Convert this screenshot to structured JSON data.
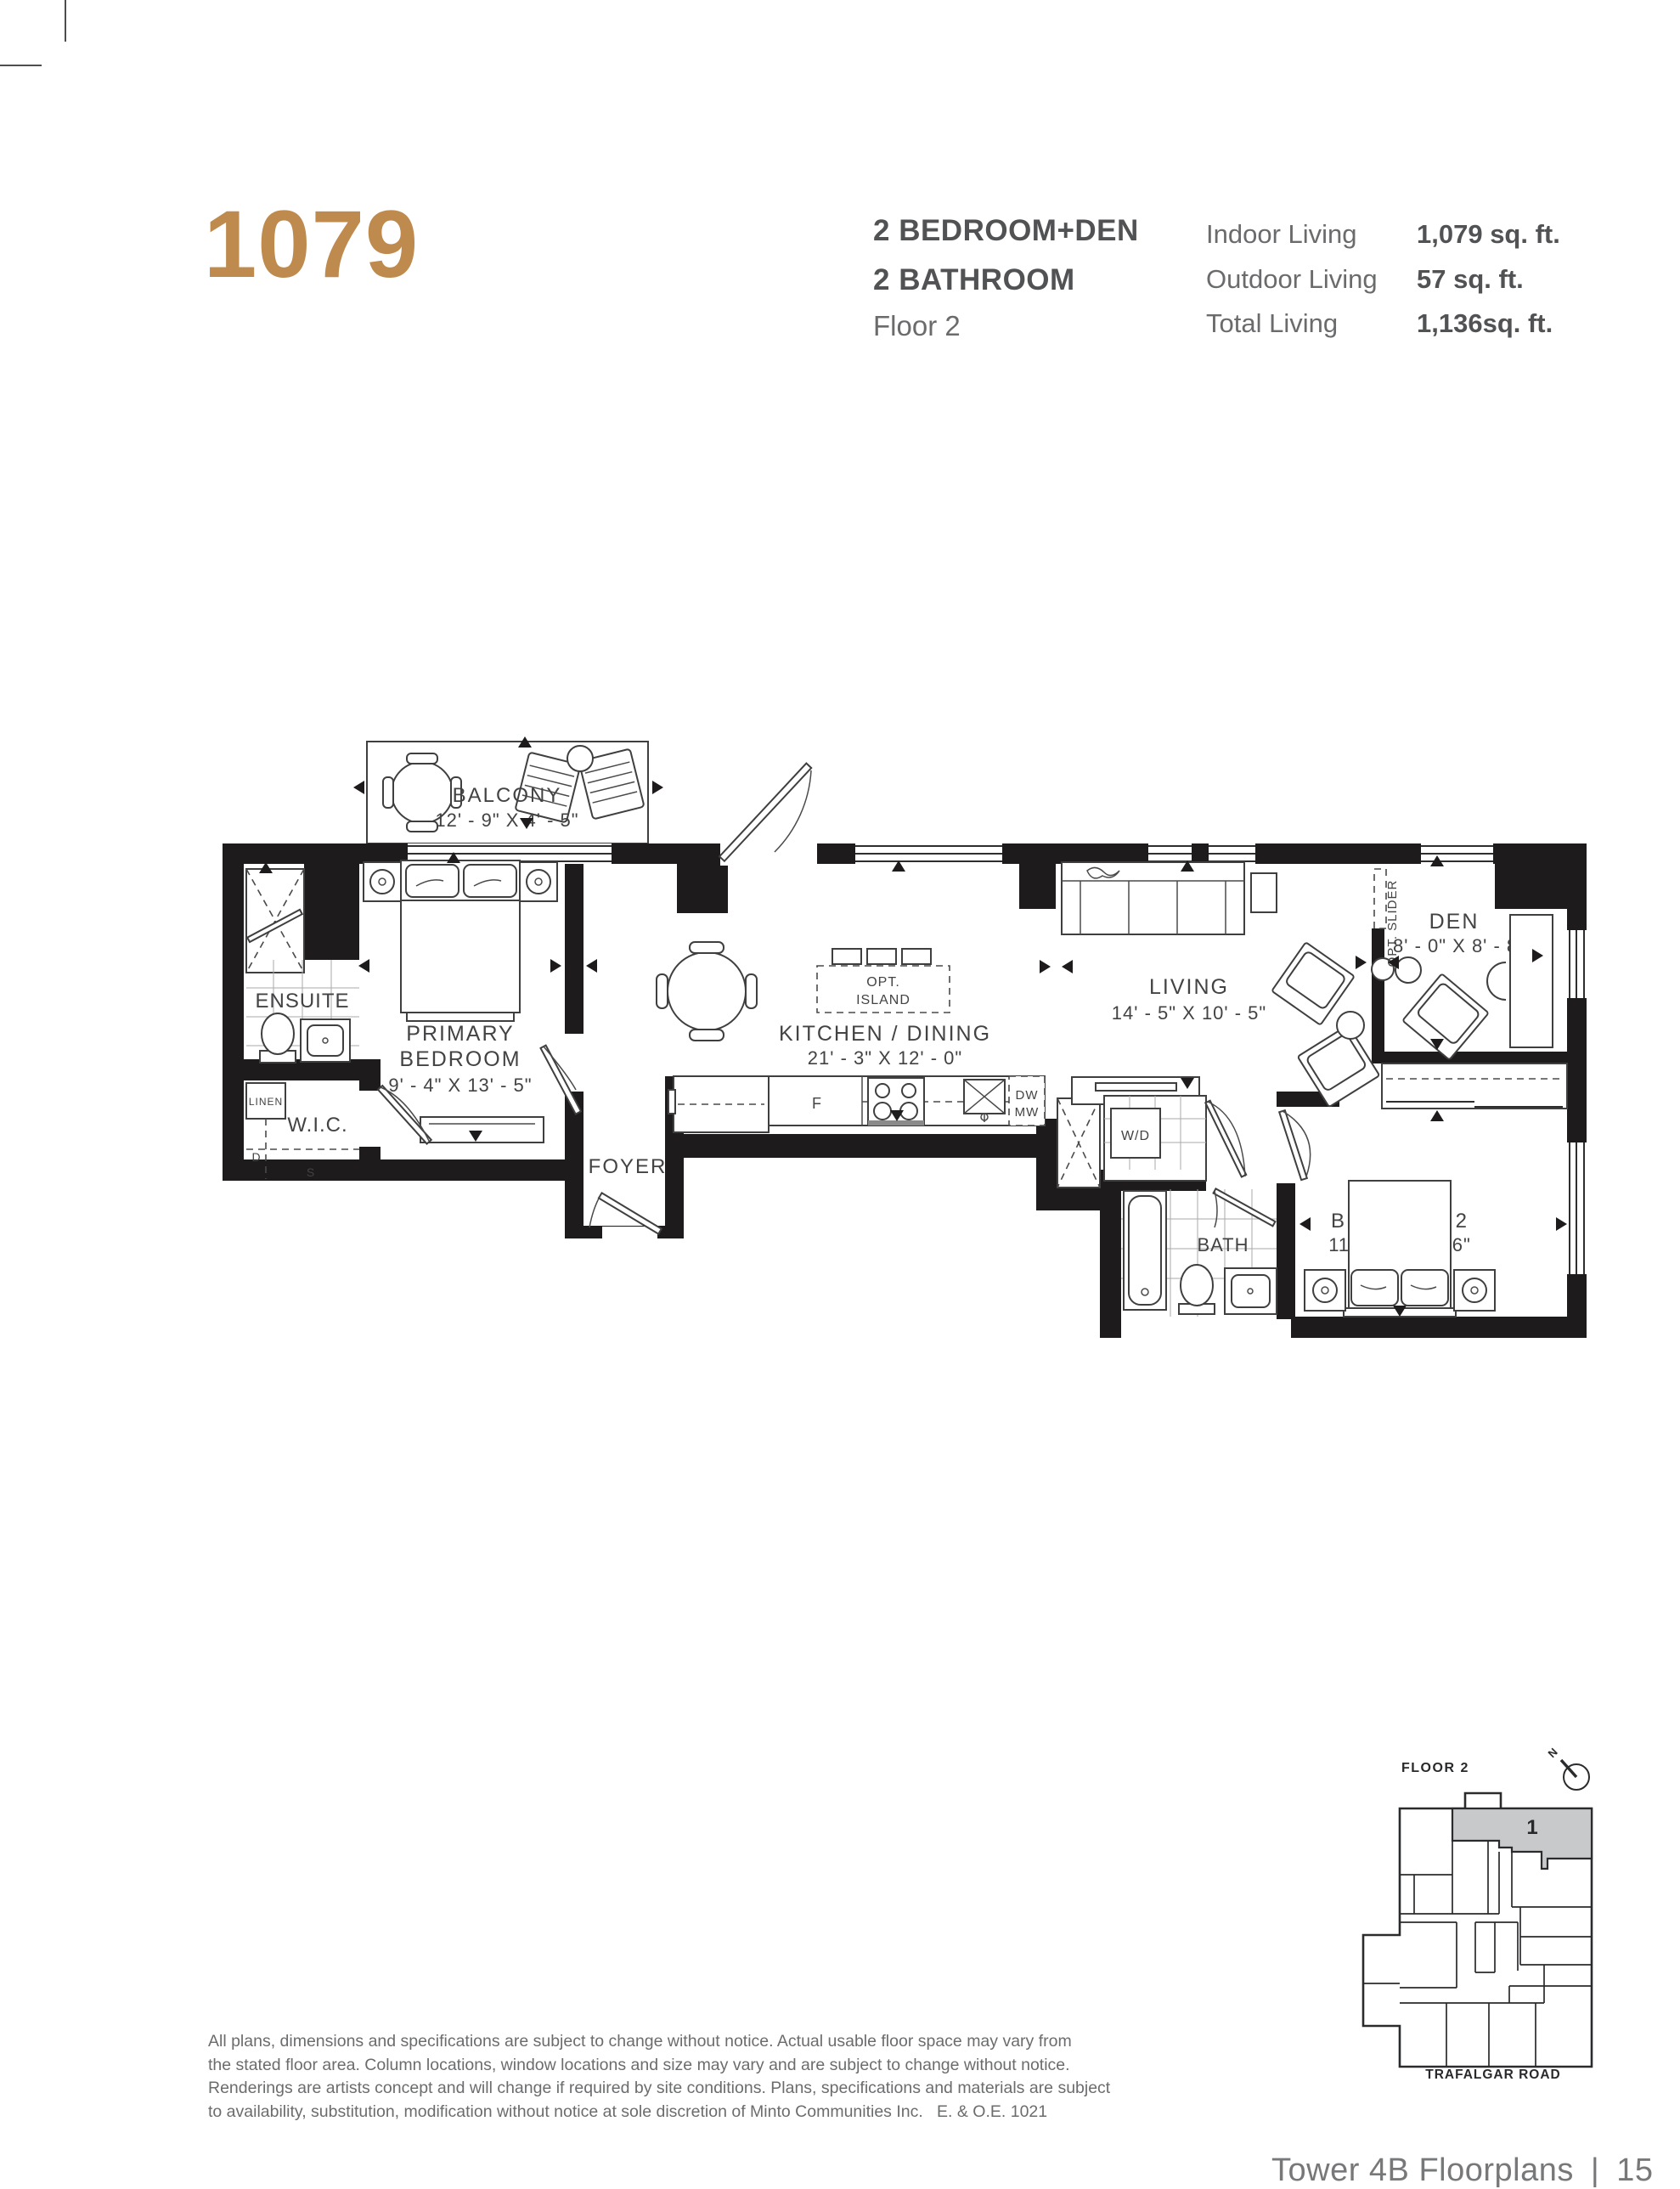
{
  "header": {
    "unit_number": "1079",
    "unit_type_line1": "2 BEDROOM+DEN",
    "unit_type_line2": "2 BATHROOM",
    "floor_label": "Floor 2",
    "stats": [
      {
        "label": "Indoor Living",
        "value": "1,079 sq. ft."
      },
      {
        "label": "Outdoor Living",
        "value": "57 sq. ft."
      },
      {
        "label": "Total Living",
        "value": "1,136sq. ft."
      }
    ]
  },
  "plan": {
    "balcony": {
      "name": "BALCONY",
      "dims": "12' - 9\" X 4' - 5\""
    },
    "primary_bedroom": {
      "name_line1": "PRIMARY",
      "name_line2": "BEDROOM",
      "dims": "9' - 4\" X 13' - 5\""
    },
    "ensuite": {
      "name": "ENSUITE"
    },
    "wic": {
      "name": "W.I.C."
    },
    "linen": {
      "name": "LINEN"
    },
    "dryer_label": "D",
    "shelf_label": "S",
    "foyer": {
      "name": "FOYER"
    },
    "kitchen_dining": {
      "name": "KITCHEN / DINING",
      "dims": "21' - 3\" X 12' - 0\""
    },
    "opt_island": {
      "line1": "OPT.",
      "line2": "ISLAND"
    },
    "fridge_label": "F",
    "dw_label": "DW",
    "mw_label": "MW",
    "living": {
      "name": "LIVING",
      "dims": "14' - 5\" X 10' - 5\""
    },
    "den": {
      "name": "DEN",
      "dims": "8' - 0\" X 8' - 8\""
    },
    "opt_slider": "OPT. SLIDER",
    "wd_label": "W/D",
    "bath": {
      "name": "BATH"
    },
    "bedroom2": {
      "name": "BEDROOM 2",
      "dims": "11' - 0\" X 9' - 6\""
    }
  },
  "keyplan": {
    "title": "FLOOR 2",
    "north": "N",
    "unit": "1",
    "street": "TRAFALGAR ROAD"
  },
  "footer": {
    "disclaimer_lines": [
      "All plans, dimensions and specifications are subject to change without notice. Actual usable floor space may vary from",
      "the stated floor area. Column locations, window locations and size may vary and are subject to change without notice.",
      "Renderings are artists concept and will change if required by site conditions. Plans, specifications and materials are subject",
      "to availability, substitution, modification without notice at sole discretion of Minto Communities Inc.   E. & O.E. 1021"
    ],
    "page_label": "Tower 4B Floorplans",
    "separator": "|",
    "page_number": "15"
  },
  "colors": {
    "accent": "#BE8A4E",
    "wall": "#1d1b1c",
    "keyplan_highlight": "#c8c9cb"
  }
}
